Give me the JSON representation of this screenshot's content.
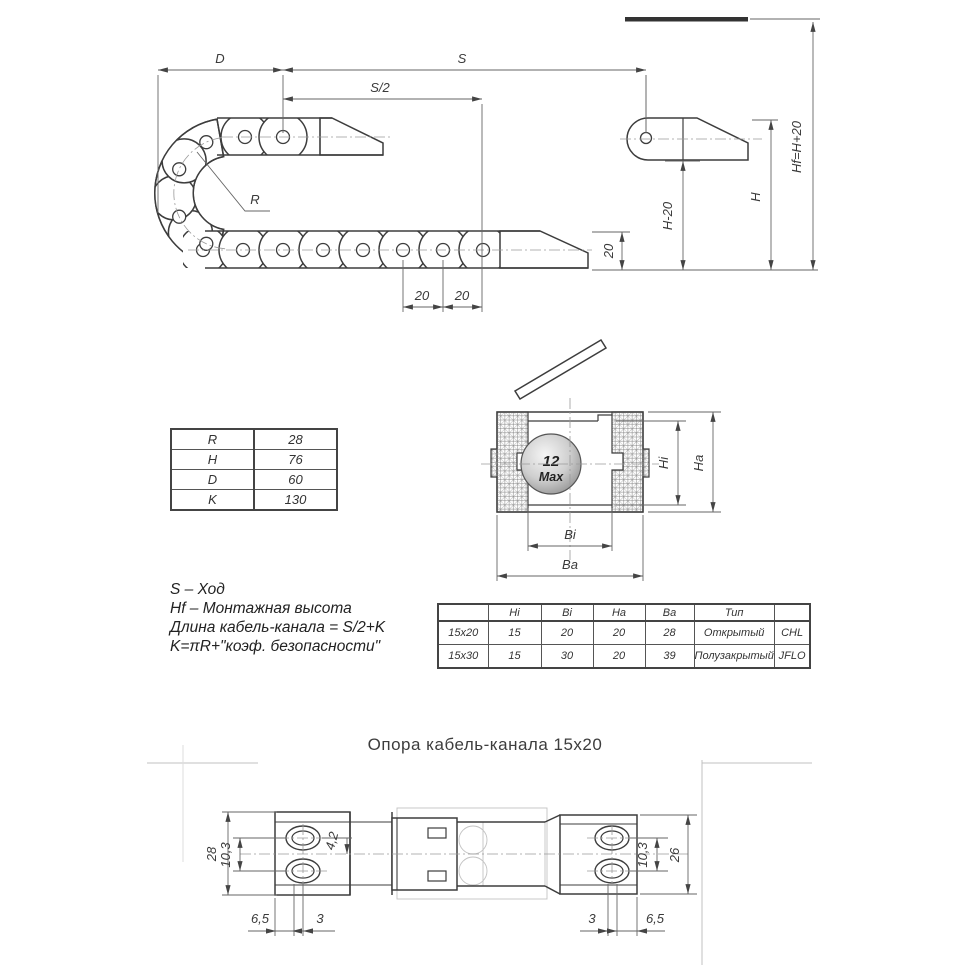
{
  "top_view": {
    "dims": {
      "d": "D",
      "s": "S",
      "s_half": "S/2",
      "r": "R",
      "pitch20a": "20",
      "pitch20b": "20",
      "v20": "20",
      "h_minus_20": "H-20",
      "h": "H",
      "hf": "Hf=H+20"
    }
  },
  "params_table": {
    "rows": [
      [
        "R",
        "28"
      ],
      [
        "H",
        "76"
      ],
      [
        "D",
        "60"
      ],
      [
        "K",
        "130"
      ]
    ]
  },
  "section_view": {
    "ball_line1": "12",
    "ball_line2": "Max",
    "dim_hi": "Hi",
    "dim_ha": "Ha",
    "dim_bi": "Bi",
    "dim_ba": "Ba"
  },
  "notes": [
    "S – Ход",
    "Hf – Монтажная высота",
    "Длина кабель-канала = S/2+K",
    "K=πR+\"коэф. безопасности\""
  ],
  "spec_table": {
    "headers": [
      "",
      "Hi",
      "Bi",
      "Ha",
      "Ba",
      "Тип",
      ""
    ],
    "rows": [
      [
        "15x20",
        "15",
        "20",
        "20",
        "28",
        "Открытый",
        "CHL"
      ],
      [
        "15x30",
        "15",
        "30",
        "20",
        "39",
        "Полузакрытый",
        "JFLO"
      ]
    ]
  },
  "support_view": {
    "title": "Опора кабель-канала 15x20",
    "dims": {
      "w28": "28",
      "l103": "10,3",
      "d42": "4,2",
      "l65": "6,5",
      "l3": "3",
      "r3": "3",
      "r65": "6,5",
      "r103": "10,3",
      "w26": "26"
    }
  }
}
